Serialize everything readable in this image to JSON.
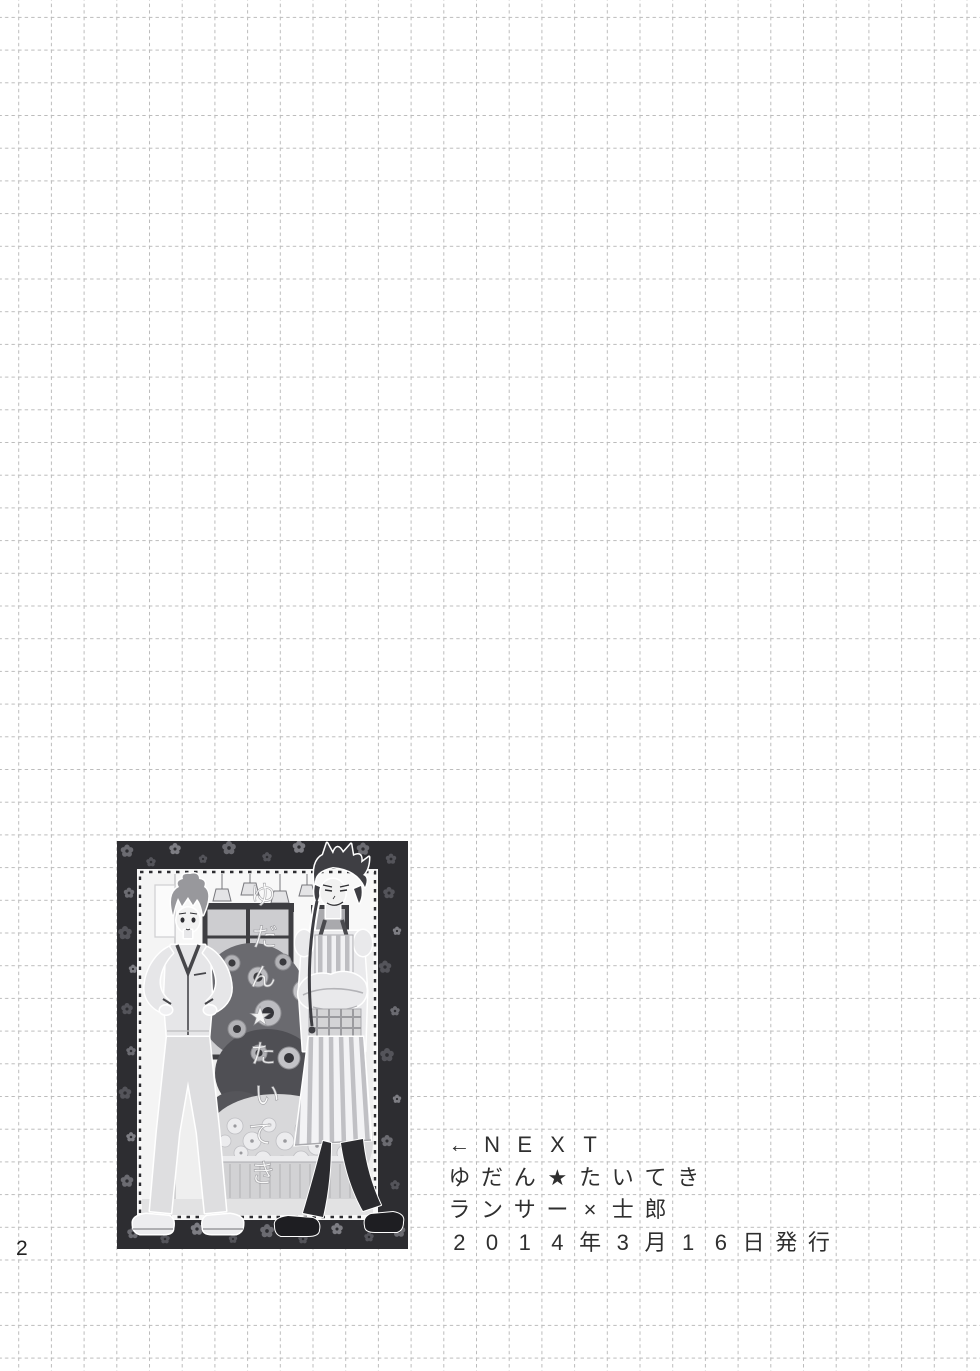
{
  "page": {
    "number": "2",
    "background_color": "#ffffff",
    "grid_line_color": "#bcbcbc",
    "grid_cell_px": 32.7
  },
  "colophon": {
    "next_label": "←NEXT",
    "title": "ゆだん★たいてき",
    "pairing": "ランサー×士郎",
    "publication_date": "2014年3月16日発行"
  },
  "illustration": {
    "alt": "grayscale-cover-art-two-characters-in-flower-shop-with-sunflowers-dark-floral-stamp-frame",
    "frame_color": "#2d2d31",
    "watermark": [
      "ゆ",
      "だ",
      "ん",
      "★",
      "た",
      "い",
      "て",
      "き"
    ]
  }
}
